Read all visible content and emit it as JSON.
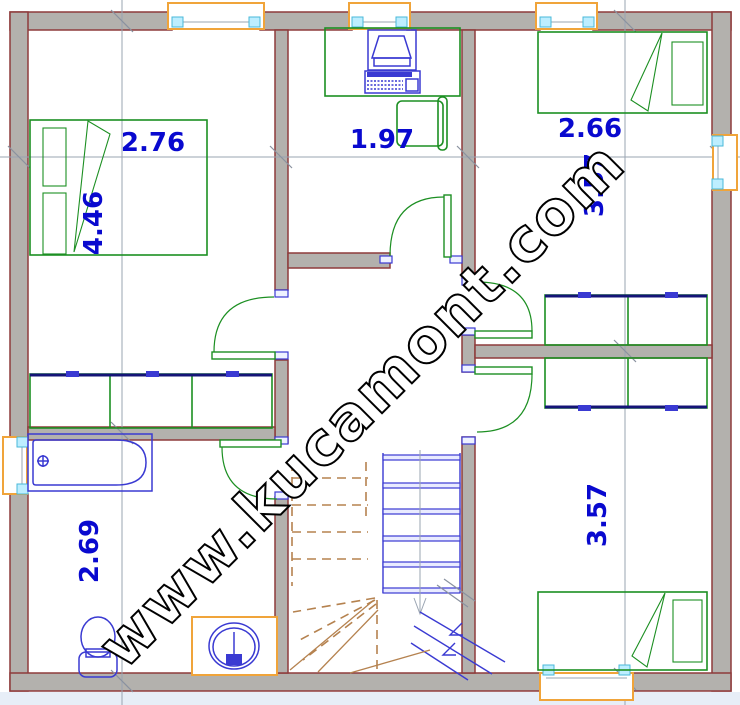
{
  "watermark": {
    "text": "www.kucamont.com"
  },
  "dimensions": {
    "bedroom_tl_width": "2.76",
    "bedroom_tl_height": "4.46",
    "study_width": "1.97",
    "bedroom_tr_width": "2.66",
    "bedroom_tr_height": "3.57",
    "bathroom_height": "2.69",
    "bedroom_br_height": "3.57"
  },
  "colors": {
    "wall-fill": "#b3b1ad",
    "wall-edge": "#8e3b3b",
    "green": "#1c8f22",
    "blue": "#3a3ad2",
    "navy": "#141477",
    "orange": "#f0a43a",
    "dim": "#0909cf",
    "grid": "#9aa4b2",
    "brown": "#b5824f"
  }
}
